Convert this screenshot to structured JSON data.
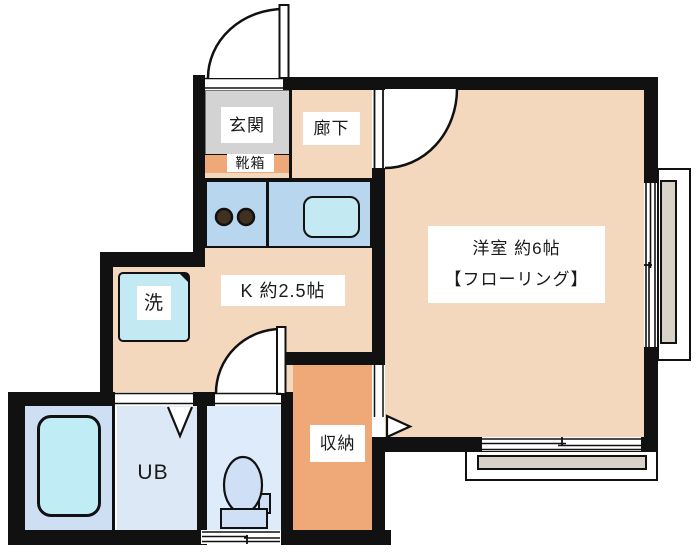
{
  "floor_plan": {
    "entrance": {
      "label": "玄関"
    },
    "shoe_box": {
      "label": "靴箱"
    },
    "hallway": {
      "label": "廊下"
    },
    "kitchen": {
      "label": "K 約2.5帖"
    },
    "main_room": {
      "label": "洋室 約6帖",
      "sub_label": "【フローリング】"
    },
    "washing_machine": {
      "label": "洗"
    },
    "unit_bath": {
      "label": "UB"
    },
    "storage": {
      "label": "収納"
    }
  },
  "colors": {
    "wall": "#111111",
    "room_tan": "#f4d8bd",
    "storage_orange": "#efa877",
    "entrance_gray": "#d3d3d3",
    "counter_blue": "#b9d6ef",
    "fixture_cyan": "#c3eaf3",
    "unit_bath_blue": "#dce8f6",
    "tub_zone_blue": "#cfdff3",
    "toilet_room_blue": "#ddebfb",
    "toilet_fixture_blue": "#cfe0f6",
    "balcony_gray": "#d8d2c9"
  }
}
